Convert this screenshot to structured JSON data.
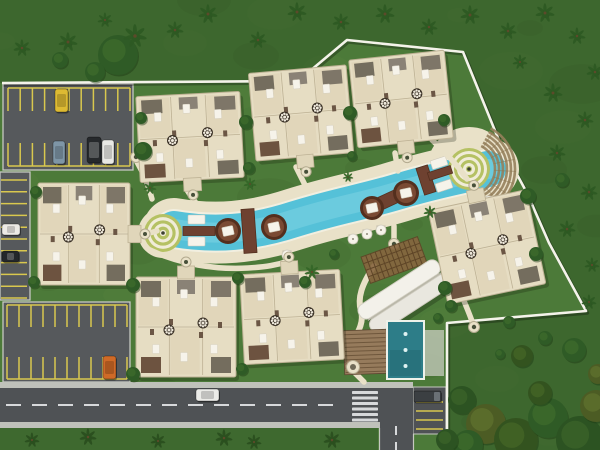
{
  "meta": {
    "type": "aerial-site-plan-rendering",
    "description": "Top-down 3D master plan of a residential resort: condo building clusters around a curved lagoon pool, parking lots, perimeter wall, road with crosswalk, palm landscaping"
  },
  "palette": {
    "grass": "#4c7a39",
    "outside_shade": "rgba(10,35,8,0.22)",
    "asphalt": "#56595c",
    "asphalt_dark": "#4f5255",
    "stripe": "#d9c84e",
    "curb": "#c6c8c1",
    "sidewalk": "#bfc1ba",
    "road_line": "#d7d9db",
    "deck": "#e9e1c8",
    "pool_rim": "#f2efe0",
    "water": "#55c1d8",
    "water_light": "#7dd3e3",
    "brown": "#6e4130",
    "brown_dark": "#542f1e",
    "building": "#e6ddc3",
    "building_line": "#bdb194",
    "building_unit": "#ded3b5",
    "roof_dark": "#746d5e",
    "roof_gray": "#8a8276",
    "furniture": "#6b5645",
    "white": "#f6f3ea",
    "ring_olive": "#b5c163",
    "wall": "#f4f3ea",
    "median": "#3e692f",
    "tree": "#2f5b26",
    "tree_light": "#3c6a2c",
    "palm": "#2d5a23",
    "step": "#96815c",
    "lap_pool": "#2d7d88",
    "wood": "#967b5c"
  },
  "wall": {
    "points": [
      [
        2,
        83
      ],
      [
        298,
        81
      ],
      [
        347,
        40
      ],
      [
        463,
        52
      ],
      [
        500,
        143
      ],
      [
        527,
        193
      ],
      [
        549,
        243
      ],
      [
        586,
        311
      ],
      [
        447,
        323
      ],
      [
        447,
        434
      ]
    ]
  },
  "parking": {
    "nw_lot": {
      "x": 3,
      "y": 84,
      "w": 130,
      "h": 86,
      "sx1": 8,
      "sx2": 130,
      "n": 11,
      "rows": [
        {
          "y1": 88,
          "y2": 111,
          "cap": 88
        },
        {
          "y1": 143,
          "y2": 166,
          "cap": 166
        }
      ]
    },
    "west_strip": {
      "x": 0,
      "y": 172,
      "w": 30,
      "h": 128,
      "y1": 180,
      "y2": 298,
      "n": 11,
      "gx1": 1,
      "gx2": 27
    },
    "sw_lot": {
      "x": 3,
      "y": 302,
      "w": 127,
      "h": 80,
      "sx1": 7,
      "sx2": 127,
      "n": 11,
      "rows": [
        {
          "y1": 305,
          "y2": 327,
          "cap": 305
        },
        {
          "y1": 357,
          "y2": 379,
          "cap": 379
        }
      ]
    },
    "east_pocket": {
      "x": 413,
      "y": 387,
      "w": 33,
      "h": 47,
      "stripe_ys": [
        402,
        411,
        420,
        429
      ],
      "gx1": 416,
      "gx2": 443
    }
  },
  "road": {
    "main": {
      "x": 0,
      "y": 388,
      "w": 413,
      "h": 34
    },
    "center_dash": {
      "x1": 6,
      "x2": 342,
      "y": 405
    },
    "crosswalk": {
      "x": 352,
      "w": 26,
      "bar_h": 3,
      "ys": [
        391,
        396.5,
        402,
        407.5,
        413,
        418.5
      ]
    },
    "south_branch": {
      "x": 380,
      "y": 422,
      "w": 33,
      "h": 28,
      "dash_x": 396
    },
    "sidewalk_north": {
      "x": 0,
      "y": 382,
      "w": 413,
      "h": 6
    },
    "sidewalk_south": {
      "x": 0,
      "y": 422,
      "w": 380,
      "h": 6
    },
    "median": {
      "x": 0,
      "y": 428,
      "w": 378,
      "h": 22
    }
  },
  "pool": {
    "centerline": "M 174,229 C 215,236 252,233 295,219 C 340,205 360,203 400,191 C 440,179 462,176 488,169",
    "deck_width": 62,
    "rim_width": 40,
    "water_width": 36,
    "core_width": 20,
    "deck_ellipse": {
      "cx": 368,
      "cy": 183,
      "rx": 54,
      "ry": 14,
      "rot": -18
    },
    "left_circle": {
      "cx": 163,
      "cy": 233,
      "r": 19,
      "rings": 6,
      "deck_r": 25
    },
    "right_circle": {
      "cx": 469,
      "cy": 169,
      "r": 21,
      "rings": 7,
      "deck_r": 42
    },
    "islands": [
      [
        228,
        231,
        13
      ],
      [
        274,
        227,
        13
      ],
      [
        372,
        208,
        12
      ],
      [
        406,
        193,
        13
      ]
    ],
    "bridges": [
      {
        "cx": 249,
        "cy": 231,
        "w": 13,
        "h": 44,
        "rot": -4
      },
      {
        "cx": 388,
        "cy": 200,
        "w": 42,
        "h": 13,
        "rot": -25
      },
      {
        "cx": 426,
        "cy": 180,
        "w": 12,
        "h": 28,
        "rot": -18
      },
      {
        "cx": 199,
        "cy": 231,
        "w": 32,
        "h": 9,
        "rot": 0
      },
      {
        "cx": 440,
        "cy": 173,
        "w": 24,
        "h": 8,
        "rot": -18
      }
    ],
    "loungers": [
      [
        188,
        215,
        17,
        9,
        0
      ],
      [
        188,
        237,
        17,
        9,
        0
      ],
      [
        430,
        161,
        16,
        9,
        -18
      ],
      [
        435,
        184,
        16,
        9,
        -18
      ]
    ],
    "umbrellas": [
      [
        287,
        255
      ],
      [
        353,
        239
      ],
      [
        367,
        234
      ],
      [
        381,
        230
      ],
      [
        489,
        201
      ]
    ],
    "arc_steps": {
      "cx": 469,
      "cy": 169,
      "r1": 26,
      "r2": 46,
      "a1": -62,
      "a2": 68
    }
  },
  "amenity": {
    "pergola": {
      "cx": 394,
      "cy": 260,
      "w": 60,
      "h": 28,
      "rot": -20
    },
    "clubhouse": {
      "cx": 404,
      "cy": 297,
      "len": 94,
      "panel_w": 16,
      "rot": -33
    },
    "lap_pool": {
      "x": 388,
      "y": 322,
      "w": 35,
      "h": 56,
      "dot_ys": [
        334,
        350,
        366
      ]
    },
    "wood_deck": {
      "x": 344,
      "y": 330,
      "w": 43,
      "h": 44,
      "rot": -2
    },
    "patio": {
      "x": 424,
      "y": 330,
      "w": 20,
      "h": 46
    },
    "winding_path": "M 374,266 C 362,284 357,298 361,311 C 364,321 359,331 353,341",
    "spa_node": [
      353,
      367
    ]
  },
  "clusters": [
    {
      "cx": 190,
      "cy": 137,
      "w": 104,
      "h": 86,
      "rot": -3,
      "tower": "bottom"
    },
    {
      "cx": 301,
      "cy": 113,
      "w": 98,
      "h": 88,
      "rot": -5,
      "tower": "bottom"
    },
    {
      "cx": 401,
      "cy": 99,
      "w": 96,
      "h": 88,
      "rot": -6,
      "tower": "bottom"
    },
    {
      "cx": 84,
      "cy": 234,
      "w": 92,
      "h": 102,
      "rot": 0,
      "tower": "right"
    },
    {
      "cx": 186,
      "cy": 327,
      "w": 100,
      "h": 100,
      "rot": 0,
      "tower": "top"
    },
    {
      "cx": 292,
      "cy": 317,
      "w": 100,
      "h": 90,
      "rot": -3,
      "tower": "top"
    },
    {
      "cx": 487,
      "cy": 247,
      "w": 100,
      "h": 96,
      "rot": -12,
      "tower": "top"
    }
  ],
  "walk_paths": [
    "M 137,162 C 144,174 149,187 152,199",
    "M 145,234 C 150,233 153,232 157,231",
    "M 150,250 C 180,264 215,270 248,268 C 266,267 277,265 289,261",
    "M 187,190 C 190,195 193,199 196,203",
    "M 296,167 C 299,173 302,179 305,185",
    "M 395,153 C 396,159 397,165 398,171",
    "M 432,140 C 446,153 458,166 467,179",
    "M 394,226 C 394,232 394,237 394,242",
    "M 462,296 C 466,306 470,315 473,324",
    "M 354,372 C 358,376 361,379 364,382"
  ],
  "path_nodes": [
    [
      136,
      157
    ],
    [
      394,
      244
    ],
    [
      474,
      327
    ]
  ],
  "cars": [
    {
      "name": "yellow-car",
      "x": 55,
      "y": 89,
      "w": 13,
      "h": 23,
      "color": "#ddba33",
      "dark": false
    },
    {
      "name": "gray-blue-car",
      "x": 53,
      "y": 141,
      "w": 12,
      "h": 23,
      "color": "#7e95a6",
      "dark": false
    },
    {
      "name": "black-suv",
      "x": 87,
      "y": 137,
      "w": 14,
      "h": 26,
      "color": "#26292c",
      "dark": true
    },
    {
      "name": "white-car",
      "x": 102,
      "y": 140,
      "w": 12,
      "h": 24,
      "color": "#e8e8e4",
      "dark": false
    },
    {
      "name": "white-car-west",
      "x": 2,
      "y": 224,
      "w": 18,
      "h": 11,
      "color": "#eceae6",
      "dark": false
    },
    {
      "name": "black-car-west",
      "x": 2,
      "y": 251,
      "w": 17,
      "h": 11,
      "color": "#24272a",
      "dark": true
    },
    {
      "name": "orange-car",
      "x": 103,
      "y": 356,
      "w": 13,
      "h": 23,
      "color": "#cf6a27",
      "dark": false
    },
    {
      "name": "white-car-road",
      "x": 196,
      "y": 389,
      "w": 23,
      "h": 12,
      "color": "#ebebe8",
      "dark": false
    }
  ],
  "truck": {
    "x": 414,
    "y": 391,
    "w": 27,
    "h": 11,
    "color": "#3b3f42",
    "cab": "#6a7075"
  },
  "vegetation": {
    "palms_outer": [
      [
        22,
        48,
        8
      ],
      [
        68,
        42,
        9
      ],
      [
        135,
        36,
        11
      ],
      [
        208,
        14,
        9
      ],
      [
        258,
        40,
        8
      ],
      [
        297,
        12,
        9
      ],
      [
        341,
        22,
        8
      ],
      [
        385,
        14,
        9
      ],
      [
        429,
        27,
        8
      ],
      [
        470,
        15,
        9
      ],
      [
        508,
        31,
        8
      ],
      [
        545,
        13,
        9
      ],
      [
        577,
        36,
        8
      ],
      [
        595,
        72,
        8
      ],
      [
        520,
        62,
        7
      ],
      [
        553,
        93,
        9
      ],
      [
        585,
        120,
        8
      ],
      [
        557,
        153,
        8
      ],
      [
        589,
        192,
        8
      ],
      [
        567,
        229,
        8
      ],
      [
        592,
        265,
        7
      ],
      [
        589,
        302,
        7
      ],
      [
        175,
        30,
        8
      ],
      [
        105,
        20,
        7
      ]
    ],
    "palms_median": [
      [
        32,
        440,
        7
      ],
      [
        88,
        437,
        8
      ],
      [
        158,
        441,
        7
      ],
      [
        224,
        438,
        8
      ],
      [
        254,
        442,
        7
      ],
      [
        332,
        440,
        8
      ]
    ],
    "palms_inner": [
      [
        150,
        188,
        6
      ],
      [
        250,
        184,
        6
      ],
      [
        312,
        272,
        7
      ],
      [
        348,
        177,
        5
      ],
      [
        430,
        212,
        6
      ]
    ],
    "bushes": [
      [
        118,
        55,
        20
      ],
      [
        95,
        72,
        10
      ],
      [
        60,
        60,
        8
      ],
      [
        141,
        118,
        6
      ],
      [
        143,
        151,
        9
      ],
      [
        246,
        122,
        7
      ],
      [
        249,
        168,
        6
      ],
      [
        350,
        113,
        7
      ],
      [
        352,
        156,
        5
      ],
      [
        444,
        120,
        6
      ],
      [
        36,
        192,
        6
      ],
      [
        34,
        282,
        6
      ],
      [
        133,
        285,
        7
      ],
      [
        238,
        278,
        6
      ],
      [
        133,
        374,
        7
      ],
      [
        242,
        369,
        6
      ],
      [
        305,
        282,
        6
      ],
      [
        334,
        254,
        5
      ],
      [
        445,
        288,
        7
      ],
      [
        451,
        306,
        6
      ],
      [
        438,
        318,
        5
      ],
      [
        528,
        196,
        8
      ],
      [
        509,
        322,
        6
      ],
      [
        545,
        338,
        7
      ],
      [
        500,
        354,
        5
      ],
      [
        562,
        180,
        7
      ],
      [
        536,
        254,
        7
      ]
    ],
    "canopy": [
      [
        462,
        400,
        14
      ],
      [
        486,
        424,
        20
      ],
      [
        516,
        440,
        22
      ],
      [
        548,
        418,
        20
      ],
      [
        580,
        440,
        24
      ],
      [
        596,
        406,
        16
      ],
      [
        540,
        393,
        12
      ],
      [
        468,
        445,
        15
      ],
      [
        447,
        440,
        11
      ],
      [
        598,
        374,
        10
      ],
      [
        522,
        356,
        11
      ],
      [
        574,
        350,
        12
      ]
    ]
  }
}
